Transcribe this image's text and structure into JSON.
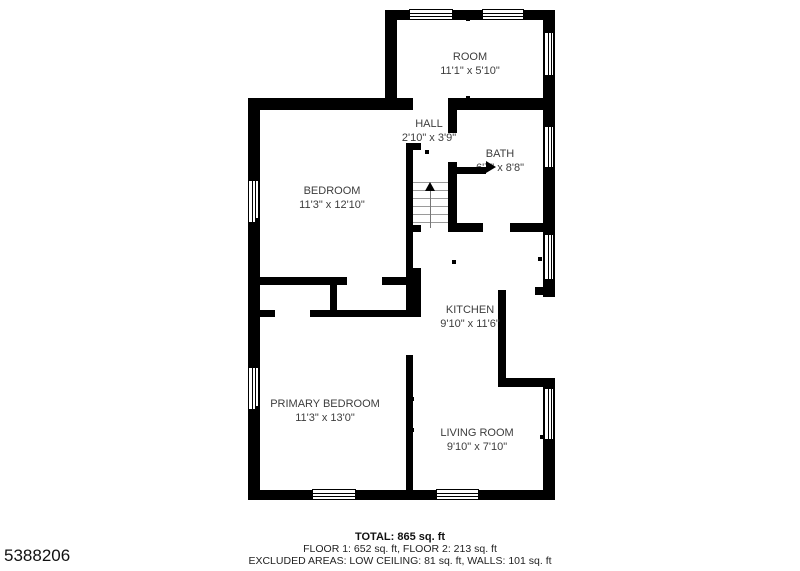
{
  "watermark": "5388206",
  "rooms": {
    "room2": {
      "name": "ROOM",
      "dims": "11'1\" x 5'10\""
    },
    "hall": {
      "name": "HALL",
      "dims": "2'10\" x 3'9\""
    },
    "bath": {
      "name": "BATH",
      "dims": "6'7\" x 8'8\""
    },
    "bedroom": {
      "name": "BEDROOM",
      "dims": "11'3\" x 12'10\""
    },
    "kitchen": {
      "name": "KITCHEN",
      "dims": "9'10\" x 11'6\""
    },
    "primary_bedroom": {
      "name": "PRIMARY BEDROOM",
      "dims": "11'3\" x 13'0\""
    },
    "living_room": {
      "name": "LIVING ROOM",
      "dims": "9'10\" x 7'10\""
    }
  },
  "footer": {
    "total": "TOTAL: 865 sq. ft",
    "floors": "FLOOR 1: 652 sq. ft, FLOOR 2: 213 sq. ft",
    "excluded": "EXCLUDED AREAS: LOW CEILING: 81 sq. ft, WALLS: 101 sq. ft"
  },
  "colors": {
    "wall": "#000000",
    "label": "#3d3d3d",
    "footer": "#222222",
    "background": "#ffffff"
  }
}
